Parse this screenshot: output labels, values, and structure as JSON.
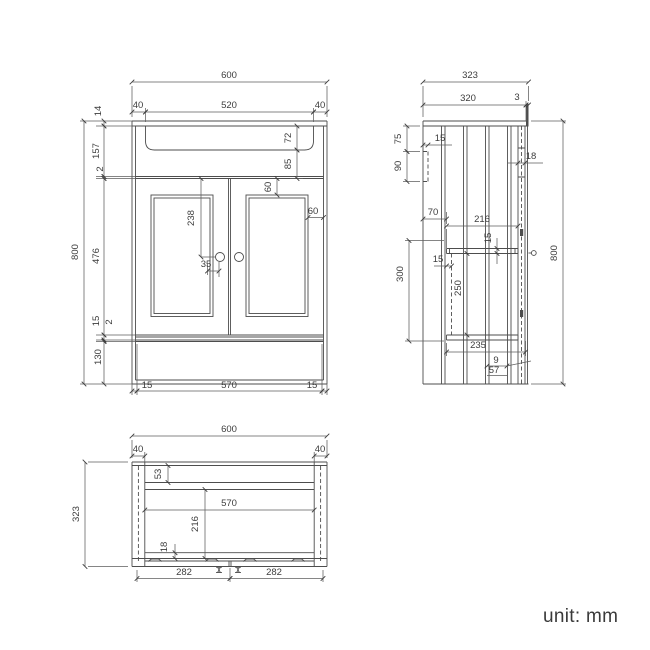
{
  "unit_label": "unit: mm",
  "front": {
    "overall_width": "600",
    "side_panel_left": "40",
    "basin_opening": "520",
    "side_panel_right": "40",
    "top_edge": "14",
    "apron_height": "157",
    "door_gap_top": "2",
    "door_height": "476",
    "bottom_rail": "15",
    "door_gap_bottom": "2",
    "plinth_height": "130",
    "overall_height": "800",
    "basin_depth": "72",
    "apron_clearance": "85",
    "panel_margin_top": "60",
    "panel_margin_side": "60",
    "handle_drop": "238",
    "handle_offset": "35",
    "base_inset_left": "15",
    "base_width": "570",
    "base_inset_right": "15"
  },
  "side": {
    "overall_depth": "323",
    "top_depth": "320",
    "back_edge": "3",
    "bracket_offset": "75",
    "bracket_thickness": "15",
    "bracket_height": "90",
    "back_panel": "18",
    "top_rail_depth": "70",
    "interior_depth": "216",
    "rail_thickness": "15",
    "runner_thickness": "15",
    "interior_height": "300",
    "rail_spacing": "250",
    "base_depth": "235",
    "plinth_lip": "9",
    "plinth_inset": "57",
    "overall_height": "800"
  },
  "plan": {
    "overall_width": "600",
    "side_panel_left": "40",
    "side_panel_right": "40",
    "back_rail_depth": "53",
    "interior_width": "570",
    "interior_depth": "216",
    "front_rail": "18",
    "door_width_left": "282",
    "door_width_right": "282",
    "overall_depth": "323"
  }
}
